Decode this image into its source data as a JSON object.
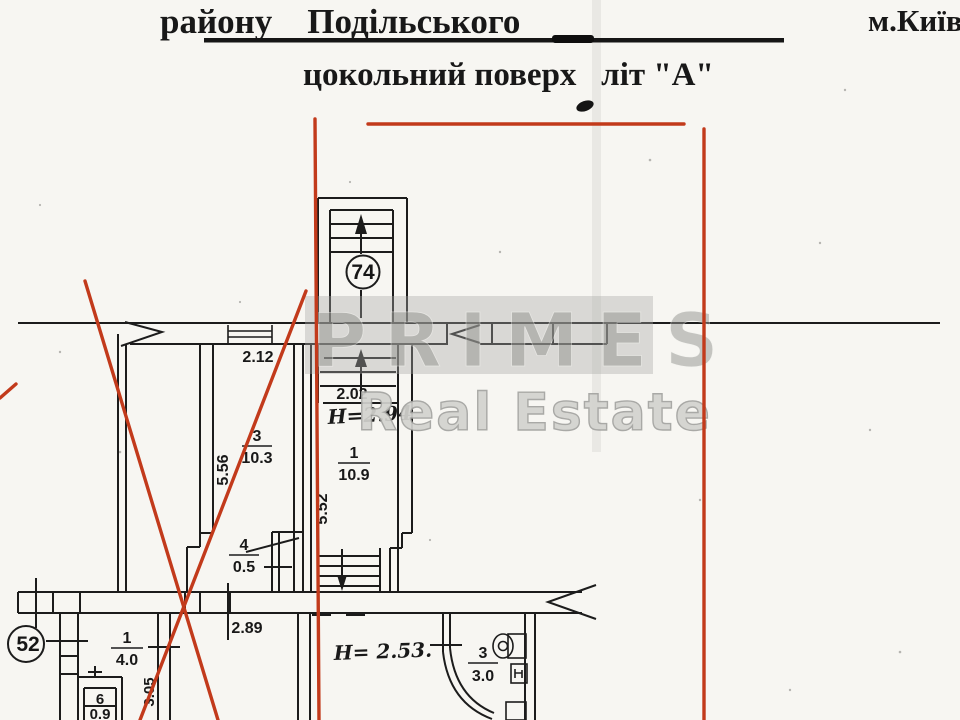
{
  "header": {
    "district": "району    Подільського",
    "city": "м.Київ",
    "floor": "цокольний поверх   літ \"А\""
  },
  "watermark": {
    "brand": "PRIMES",
    "suffix": "Real Estate"
  },
  "plan": {
    "stairwell_number": "74",
    "unit_number": "52",
    "rooms": [
      {
        "num": "3",
        "area": "10.3"
      },
      {
        "num": "1",
        "area": "10.9"
      },
      {
        "num": "4",
        "area": "0.5"
      },
      {
        "num": "1",
        "area": "4.0"
      },
      {
        "num": "6",
        "area": "0.9"
      },
      {
        "num": "3",
        "area": "3.0"
      }
    ],
    "dims": {
      "room3_width": "2.12",
      "stair_width": "2.02",
      "hall_width": "2.89",
      "room3_depth": "5.56",
      "room1_depth": "5.52",
      "lower_depth": "3.05"
    },
    "heights": {
      "upper": "H=2.94",
      "lower": "H= 2.53."
    }
  },
  "colors": {
    "red_mark": "#c23a1b",
    "ink": "#1c1c1c",
    "paper": "#f7f6f2",
    "watermark_gray": "#9a9a98"
  }
}
